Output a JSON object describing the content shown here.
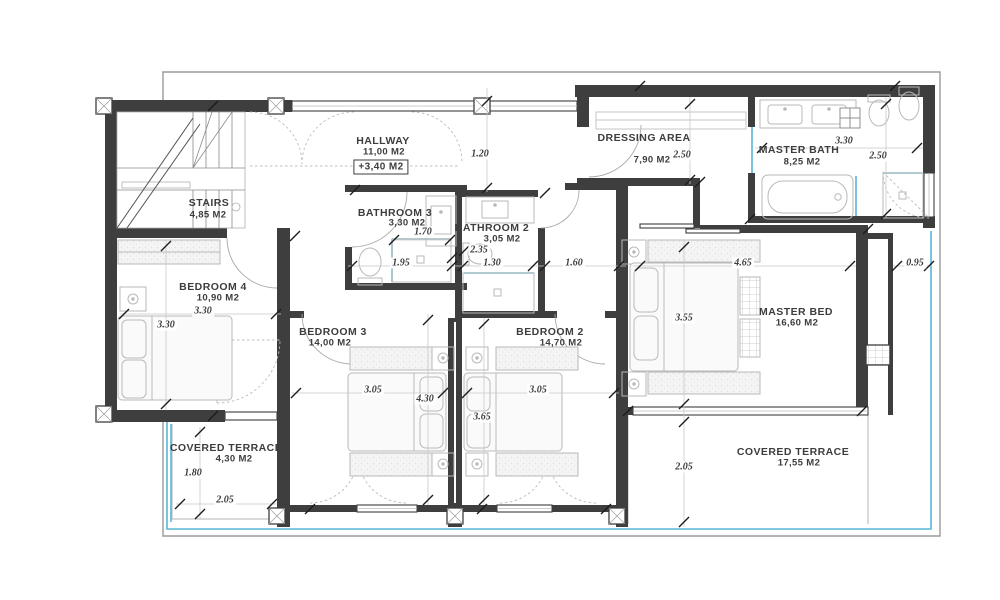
{
  "drawing": {
    "unit": "M2",
    "rooms": [
      {
        "name": "STAIRS",
        "area": "4,85 M2"
      },
      {
        "name": "HALLWAY",
        "area": "11,00 M2",
        "extra": "+3,40 M2"
      },
      {
        "name": "BATHROOM 3",
        "area": "3,30 M2"
      },
      {
        "name": "BATHROOM 2",
        "area": "3,05 M2"
      },
      {
        "name": "DRESSING AREA",
        "area": "7,90 M2"
      },
      {
        "name": "MASTER BATH",
        "area": "8,25 M2"
      },
      {
        "name": "MASTER BED",
        "area": "16,60 M2"
      },
      {
        "name": "BEDROOM 4",
        "area": "10,90 M2"
      },
      {
        "name": "BEDROOM 3",
        "area": "14,00 M2"
      },
      {
        "name": "BEDROOM 2",
        "area": "14,70 M2"
      },
      {
        "name": "COVERED TERRACE",
        "area": "4,30 M2"
      },
      {
        "name": "COVERED TERRACE",
        "area": "17,55 M2"
      }
    ],
    "dimensions": [
      "1.20",
      "2.50",
      "3.30",
      "2.50",
      "1.70",
      "2.35",
      "1.95",
      "1.30",
      "1.60",
      "4.65",
      "0.95",
      "3.30",
      "3.30",
      "3.55",
      "3.05",
      "4.30",
      "3.65",
      "3.05",
      "1.80",
      "2.05",
      "2.05"
    ],
    "colors": {
      "wall": "#3e3e3e",
      "glass_accent": "#58b6d8",
      "furniture": "#b9b9b9",
      "slab_outline": "#9a9a9a"
    }
  }
}
